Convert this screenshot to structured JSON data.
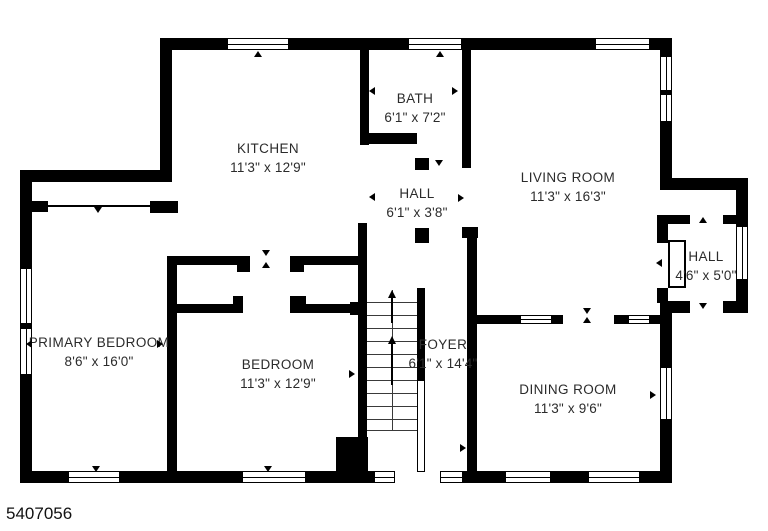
{
  "meta": {
    "id_label": "5407056",
    "plan_type": "floor-plan",
    "level_features": [
      "stairs-up",
      "front-entry",
      "side-entry-hall",
      "two-closets",
      "chimney"
    ]
  },
  "colors": {
    "wall": "#000000",
    "background": "#ffffff",
    "label_text": "#2b2b2b"
  },
  "rooms": [
    {
      "name": "KITCHEN",
      "dims": "11'3\" x 12'9\""
    },
    {
      "name": "BATH",
      "dims": "6'1\" x 7'2\""
    },
    {
      "name": "HALL",
      "dims": "6'1\" x 3'8\""
    },
    {
      "name": "LIVING ROOM",
      "dims": "11'3\" x 16'3\""
    },
    {
      "name": "HALL",
      "dims": "4'6\" x 5'0\""
    },
    {
      "name": "PRIMARY BEDROOM",
      "dims": "8'6\" x 16'0\""
    },
    {
      "name": "BEDROOM",
      "dims": "11'3\" x 12'9\""
    },
    {
      "name": "FOYER",
      "dims": "6'1\" x 14'4\""
    },
    {
      "name": "DINING ROOM",
      "dims": "11'3\" x 9'6\""
    }
  ]
}
